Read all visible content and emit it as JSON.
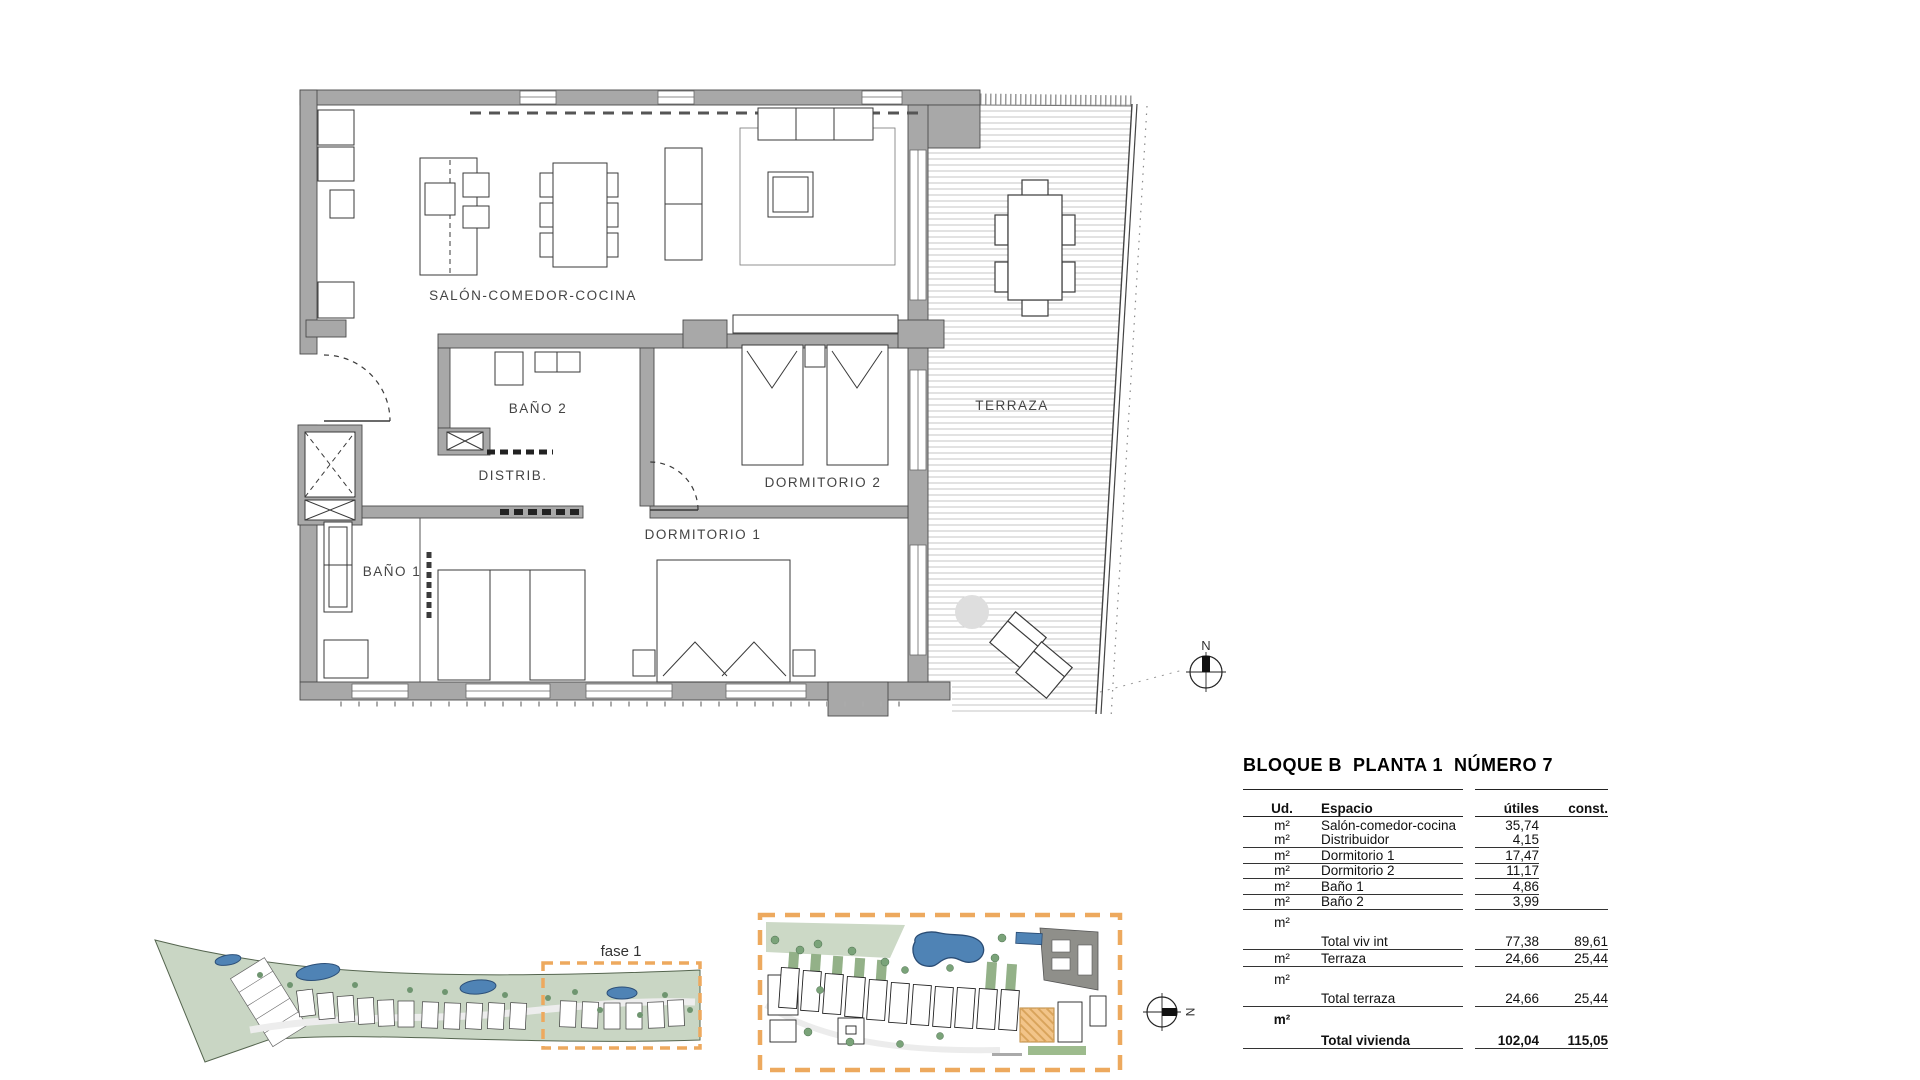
{
  "floor_plan": {
    "rooms": {
      "salon": "SALÓN-COMEDOR-COCINA",
      "bano2": "BAÑO 2",
      "distrib": "DISTRIB.",
      "dormitorio2": "DORMITORIO 2",
      "dormitorio1": "DORMITORIO 1",
      "bano1": "BAÑO 1",
      "terraza": "TERRAZA"
    },
    "compass_label": "N"
  },
  "site_overview": {
    "phase_label": "fase 1"
  },
  "site_detail": {
    "compass_label": "N"
  },
  "summary_table": {
    "title": "BLOQUE B  PLANTA 1  NÚMERO 7",
    "columns": {
      "ud": "Ud.",
      "espacio": "Espacio",
      "utiles": "útiles",
      "const": "const."
    },
    "rows": [
      {
        "ud": "m²",
        "espacio": "Salón-comedor-cocina",
        "utiles": "35,74",
        "const": ""
      },
      {
        "ud": "m²",
        "espacio": "Distribuidor",
        "utiles": "4,15",
        "const": ""
      },
      {
        "ud": "m²",
        "espacio": "Dormitorio 1",
        "utiles": "17,47",
        "const": ""
      },
      {
        "ud": "m²",
        "espacio": "Dormitorio 2",
        "utiles": "11,17",
        "const": ""
      },
      {
        "ud": "m²",
        "espacio": "Baño 1",
        "utiles": "4,86",
        "const": ""
      },
      {
        "ud": "m²",
        "espacio": "Baño 2",
        "utiles": "3,99",
        "const": ""
      },
      {
        "ud": "m²",
        "espacio": "Total viv int",
        "utiles": "77,38",
        "const": "89,61"
      },
      {
        "ud": "m²",
        "espacio": "Terraza",
        "utiles": "24,66",
        "const": "25,44"
      },
      {
        "ud": "m²",
        "espacio": "Total terraza",
        "utiles": "24,66",
        "const": "25,44"
      },
      {
        "ud": "m²",
        "espacio": "Total vivienda",
        "utiles": "102,04",
        "const": "115,05"
      }
    ]
  },
  "colors": {
    "accent_orange": "#eda95e",
    "pool_blue": "#4f83b5",
    "plan_green": "#c9d6c4",
    "wall_gray": "#a8a8a8",
    "line_dark": "#3f3f3f"
  }
}
